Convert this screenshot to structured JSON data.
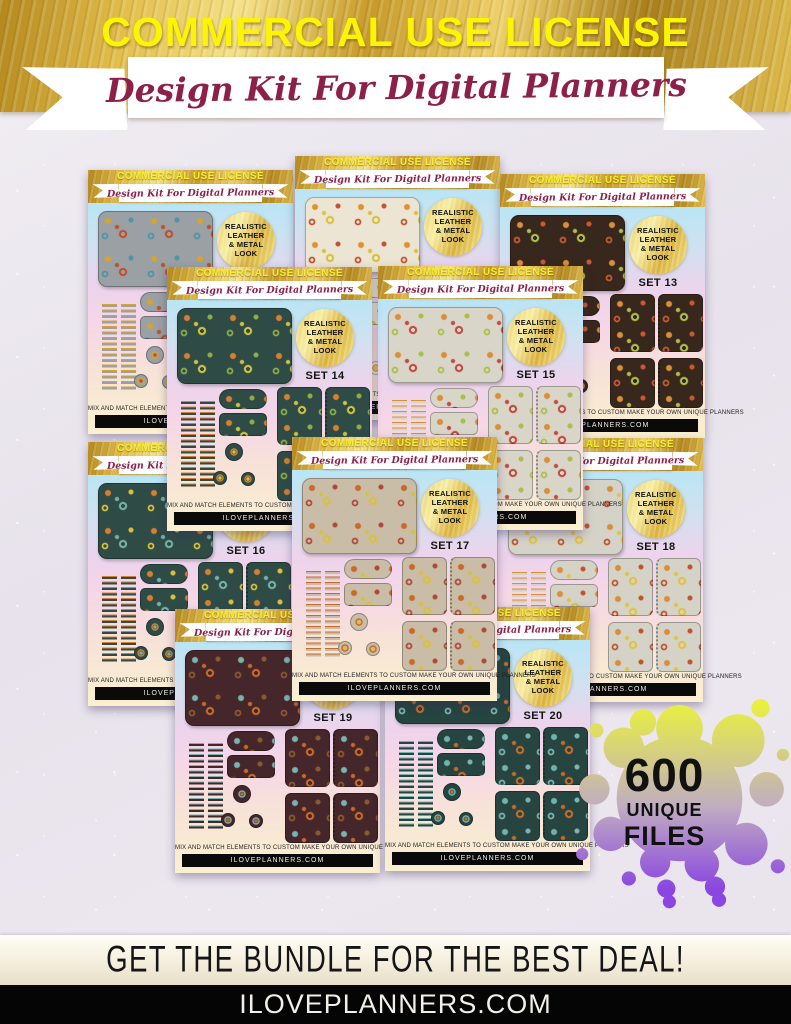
{
  "theme": {
    "gold_dark": "#a87f1b",
    "gold_light": "#f2dd7e",
    "banner_text": "#fcf405",
    "script_text": "#8c2049",
    "splat_top": "#e9f13e",
    "splat_mid": "#c0aec0",
    "splat_bottom": "#8a46e0",
    "badge_text": "#111111"
  },
  "header": {
    "title": "COMMERCIAL USE LICENSE",
    "subtitle": "Design Kit For Digital Planners"
  },
  "card_common": {
    "banner_title": "COMMERCIAL USE LICENSE",
    "banner_subtitle": "Design Kit For Digital Planners",
    "circle_lines": [
      "REALISTIC",
      "LEATHER",
      "& METAL",
      "LOOK"
    ],
    "mix_text": "MIX AND MATCH ELEMENTS TO CUSTOM MAKE YOUR OWN UNIQUE PLANNERS",
    "site_text": "ILOVEPLANNERS.COM"
  },
  "cards": [
    {
      "id": "card-top-left",
      "set_label": "",
      "x": 88,
      "y": 170,
      "z": 1,
      "pattern": {
        "base": "#9aa0a3",
        "acc1": "#d5a42c",
        "acc2": "#c04f2e",
        "acc3": "#4e93a8"
      }
    },
    {
      "id": "card-top-middle",
      "set_label": "",
      "x": 295,
      "y": 156,
      "z": 2,
      "pattern": {
        "base": "#ece5d3",
        "acc1": "#e0912f",
        "acc2": "#d9c13c",
        "acc3": "#c0522f"
      }
    },
    {
      "id": "card-set-13",
      "set_label": "SET 13",
      "x": 500,
      "y": 174,
      "z": 3,
      "pattern": {
        "base": "#38271c",
        "acc1": "#d98f3a",
        "acc2": "#aec04a",
        "acc3": "#cc5a2e"
      }
    },
    {
      "id": "card-set-18",
      "set_label": "SET 18",
      "x": 498,
      "y": 438,
      "z": 4,
      "pattern": {
        "base": "#d5d2c8",
        "acc1": "#d98f3a",
        "acc2": "#e0c43f",
        "acc3": "#c0522f"
      }
    },
    {
      "id": "card-set-16",
      "set_label": "SET 16",
      "x": 88,
      "y": 442,
      "z": 5,
      "pattern": {
        "base": "#2e4b46",
        "acc1": "#d87f2f",
        "acc2": "#76b2a7",
        "acc3": "#d9c13c"
      }
    },
    {
      "id": "card-set-15",
      "set_label": "SET 15",
      "x": 378,
      "y": 266,
      "z": 6,
      "pattern": {
        "base": "#d9d5c9",
        "acc1": "#d98f3a",
        "acc2": "#c24a3f",
        "acc3": "#a9bf49"
      }
    },
    {
      "id": "card-set-14",
      "set_label": "SET 14",
      "x": 167,
      "y": 267,
      "z": 7,
      "pattern": {
        "base": "#2e4b46",
        "acc1": "#d87f2f",
        "acc2": "#cfc43c",
        "acc3": "#8fae4a"
      }
    },
    {
      "id": "card-set-19",
      "set_label": "SET 19",
      "x": 175,
      "y": 609,
      "z": 8,
      "pattern": {
        "base": "#45262a",
        "acc1": "#79b3ae",
        "acc2": "#c96a28",
        "acc3": "#8a5a30"
      }
    },
    {
      "id": "card-set-20",
      "set_label": "SET 20",
      "x": 385,
      "y": 607,
      "z": 9,
      "pattern": {
        "base": "#264440",
        "acc1": "#6fb3ad",
        "acc2": "#c96a28",
        "acc3": "#7fb5b0"
      }
    },
    {
      "id": "card-set-17",
      "set_label": "SET 17",
      "x": 292,
      "y": 437,
      "z": 10,
      "pattern": {
        "base": "#c9bda8",
        "acc1": "#c96a28",
        "acc2": "#d9c13c",
        "acc3": "#b0483a"
      }
    }
  ],
  "badge": {
    "value": "600",
    "line1": "UNIQUE",
    "line2": "FILES"
  },
  "footer": {
    "deal_text": "GET THE BUNDLE FOR THE BEST DEAL!",
    "site_text": "ILOVEPLANNERS.COM"
  }
}
